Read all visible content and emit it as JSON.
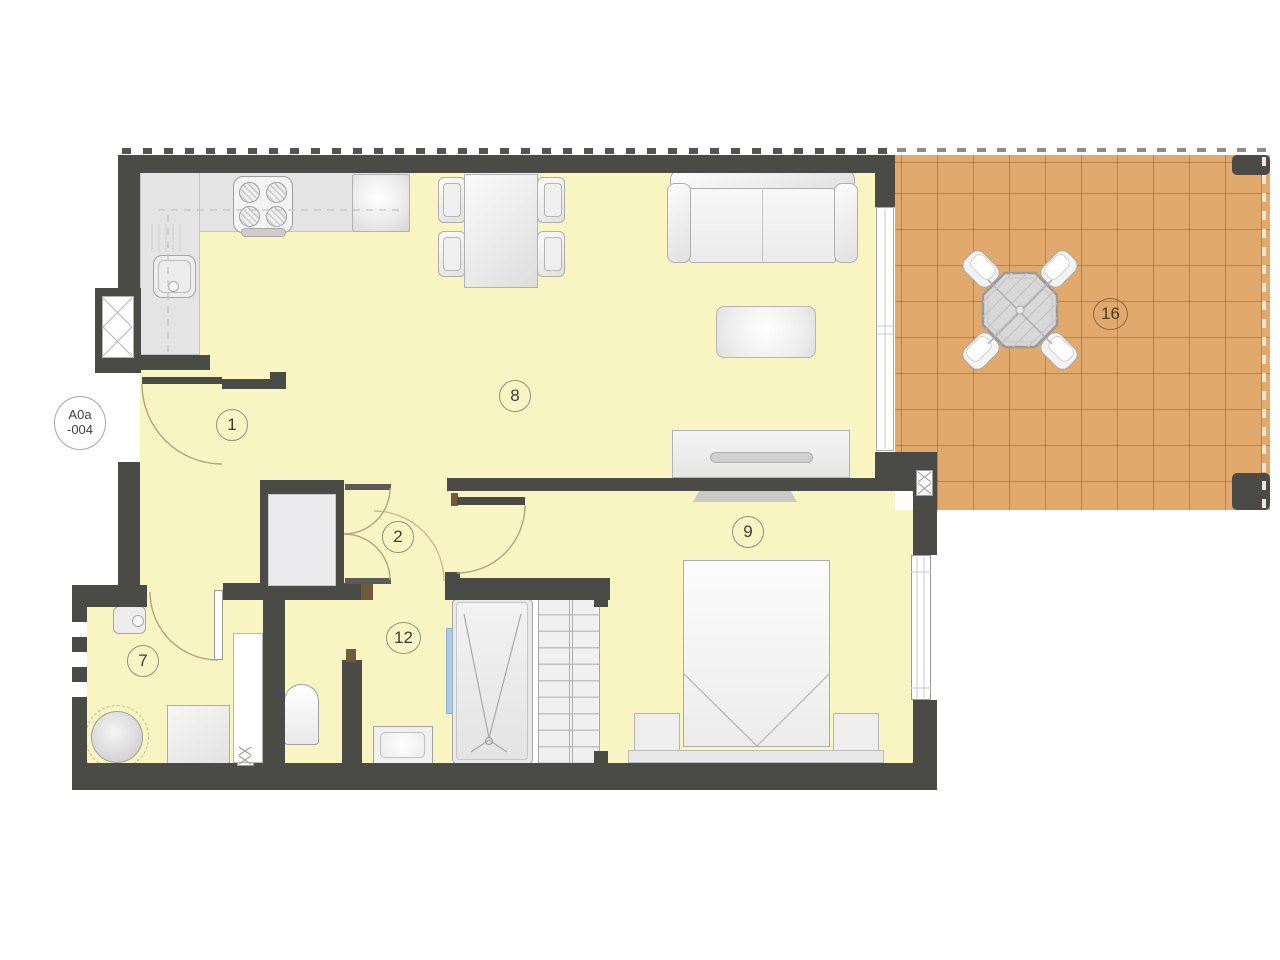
{
  "unit_label": {
    "line1": "A0a",
    "line2": "-004"
  },
  "rooms": [
    {
      "number": "1"
    },
    {
      "number": "2"
    },
    {
      "number": "7"
    },
    {
      "number": "8"
    },
    {
      "number": "9"
    },
    {
      "number": "12"
    },
    {
      "number": "16"
    }
  ],
  "colors": {
    "wall": "#4a4a47",
    "floor": "#f9f5c3",
    "terrace_tile": "#e1a96c",
    "counter": "#e4e4e4",
    "furniture": "#f2f2f2",
    "glass_screen": "#aecbe2",
    "wood_frame": "#6f5b3a"
  }
}
